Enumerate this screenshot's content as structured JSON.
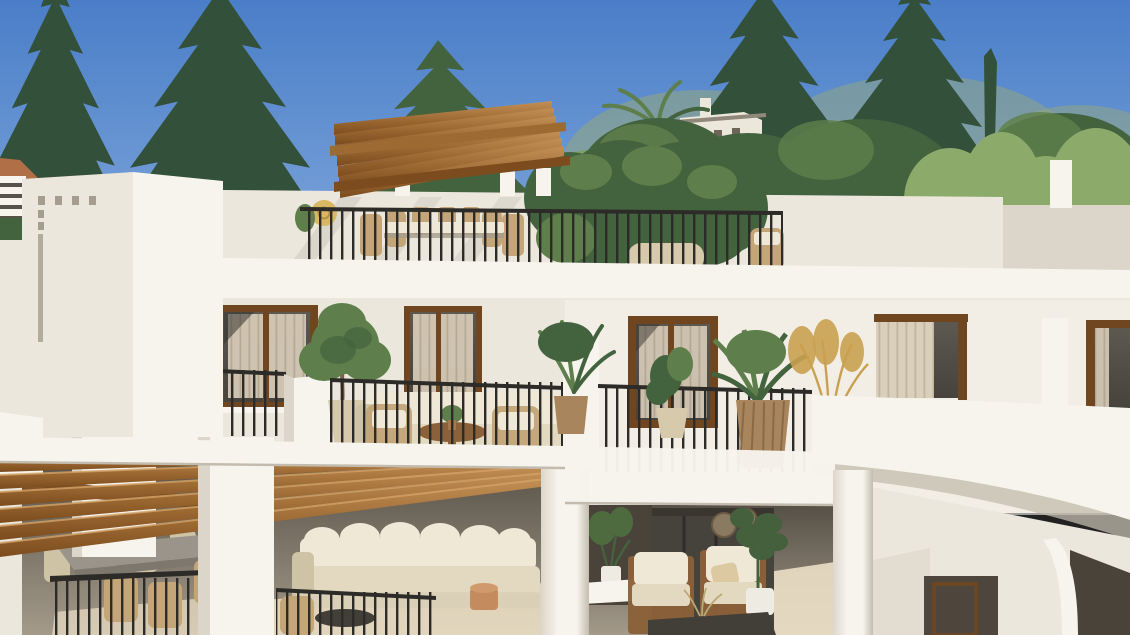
{
  "scene": {
    "description": "3D architectural render of a new-build white Mediterranean apartment block with rooftop pergola terrace, plant-filled balconies and covered ground-floor terraces, pine trees and a distant hillside villa behind",
    "type": "exterior-architectural-render",
    "canvas": {
      "width": 1130,
      "height": 635
    },
    "regions": {
      "sky": "clear blue sky",
      "background": "dark conifer and pine trees, cypress spikes, palm, bamboo shrubs, distant white villa on hillside",
      "rooftop": "roof terrace with timber pergola, outdoor dining set, straw hat on wall, green climber hedge, stone planter, wicker chair, black metal railing",
      "middle_floor": "timber-framed windows with sheer curtains, balconies with black railings, olive tree, outdoor lounge sofa with round wood coffee table, potted palms, golden pampas grass, curved white parapets",
      "ground_floor": "covered terraces under timber pergola beams, grey dining table with six chairs, cream modular sofa, two timber armchairs, fiddle-leaf plant, woven wall decor, dark glazing"
    },
    "counts": {
      "rooftop_pergola_beams": 7,
      "rooftop_pergola_posts": 4,
      "ground_pergola_beams": 6,
      "middle_floor_windows": 5,
      "balcony_railings": 4,
      "rooftop_dining_chairs": 6,
      "ground_dining_chairs": 6,
      "ground_armchairs": 2
    }
  },
  "colors": {
    "sky_top": "#4a7ec8",
    "sky_mid": "#6f9ad5",
    "sky_horizon": "#b7d0ea",
    "tree_dark": "#32503a",
    "tree_mid": "#43633f",
    "tree_light": "#5e7f4b",
    "tree_pale": "#7fa061",
    "shrub": "#8cab6a",
    "haze": "#93a87b",
    "villa_wall": "#ece7db",
    "villa_roof": "#90897b",
    "villa_dark": "#6f6557",
    "terracotta": "#b5714b",
    "roof_tile": "#b06f46",
    "wall_bright": "#f7f4ed",
    "wall_light": "#ebe7dd",
    "wall_mid": "#dcd6ca",
    "wall_shade": "#c3bcae",
    "wall_deep": "#a59d8d",
    "interior_top": "#575046",
    "interior_bottom": "#a39a8a",
    "interior_dark": "#4a433a",
    "glass": "#46423c",
    "glass_light": "#5d5951",
    "frame_wood": "#6f461f",
    "curtain": "#d9cdb9",
    "curtain_stripe": "#bfb29c",
    "wood_top": "#c29057",
    "wood_mid": "#9d6a33",
    "wood_dark": "#7c4c1e",
    "wood_hi": "#d2a268",
    "railing": "#2d2b28",
    "cushion": "#f0e8d6",
    "cushion_mid": "#e3d9c0",
    "cushion_shade": "#cfc3a6",
    "wicker": "#c3a578",
    "wood_furn": "#8a6138",
    "pot_beige": "#d6c9ac",
    "pot_white": "#eeebe2",
    "planter_wood": "#a8855c",
    "table_grey": "#9a948a",
    "table_dark": "#423e38",
    "terracotta_table": "#c38b5e",
    "pampas": "#c9a050",
    "hat": "#d8b765",
    "floor_sun": "#ecdfc6",
    "trunk": "#7a6148"
  }
}
